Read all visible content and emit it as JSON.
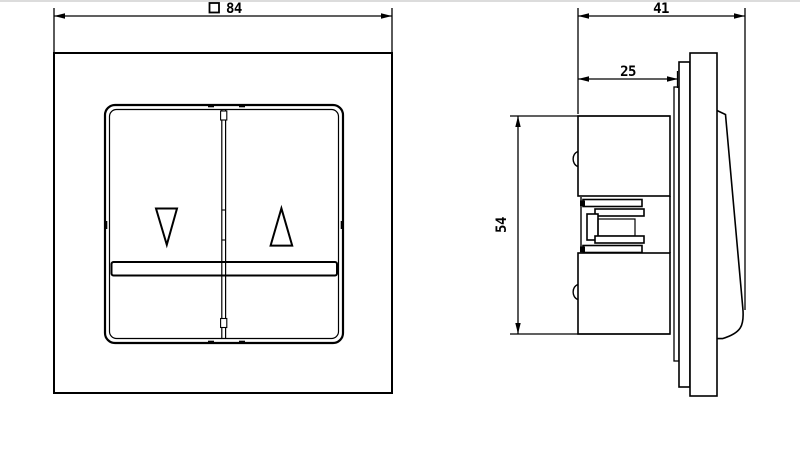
{
  "page": {
    "background_color": "#ffffff",
    "top_border_color": "#dcdcdc",
    "line_color": "#000000"
  },
  "drawing": {
    "front_view": {
      "width_dimension": {
        "symbol_icon": "square-outline",
        "value": "84"
      },
      "rocker_symbols": {
        "left_icon": "triangle-down-outline",
        "right_icon": "triangle-up-outline"
      }
    },
    "side_view": {
      "total_depth_dimension": {
        "value": "41"
      },
      "insert_depth_dimension": {
        "value": "25"
      },
      "mechanism_height_dimension": {
        "value": "54"
      }
    }
  }
}
